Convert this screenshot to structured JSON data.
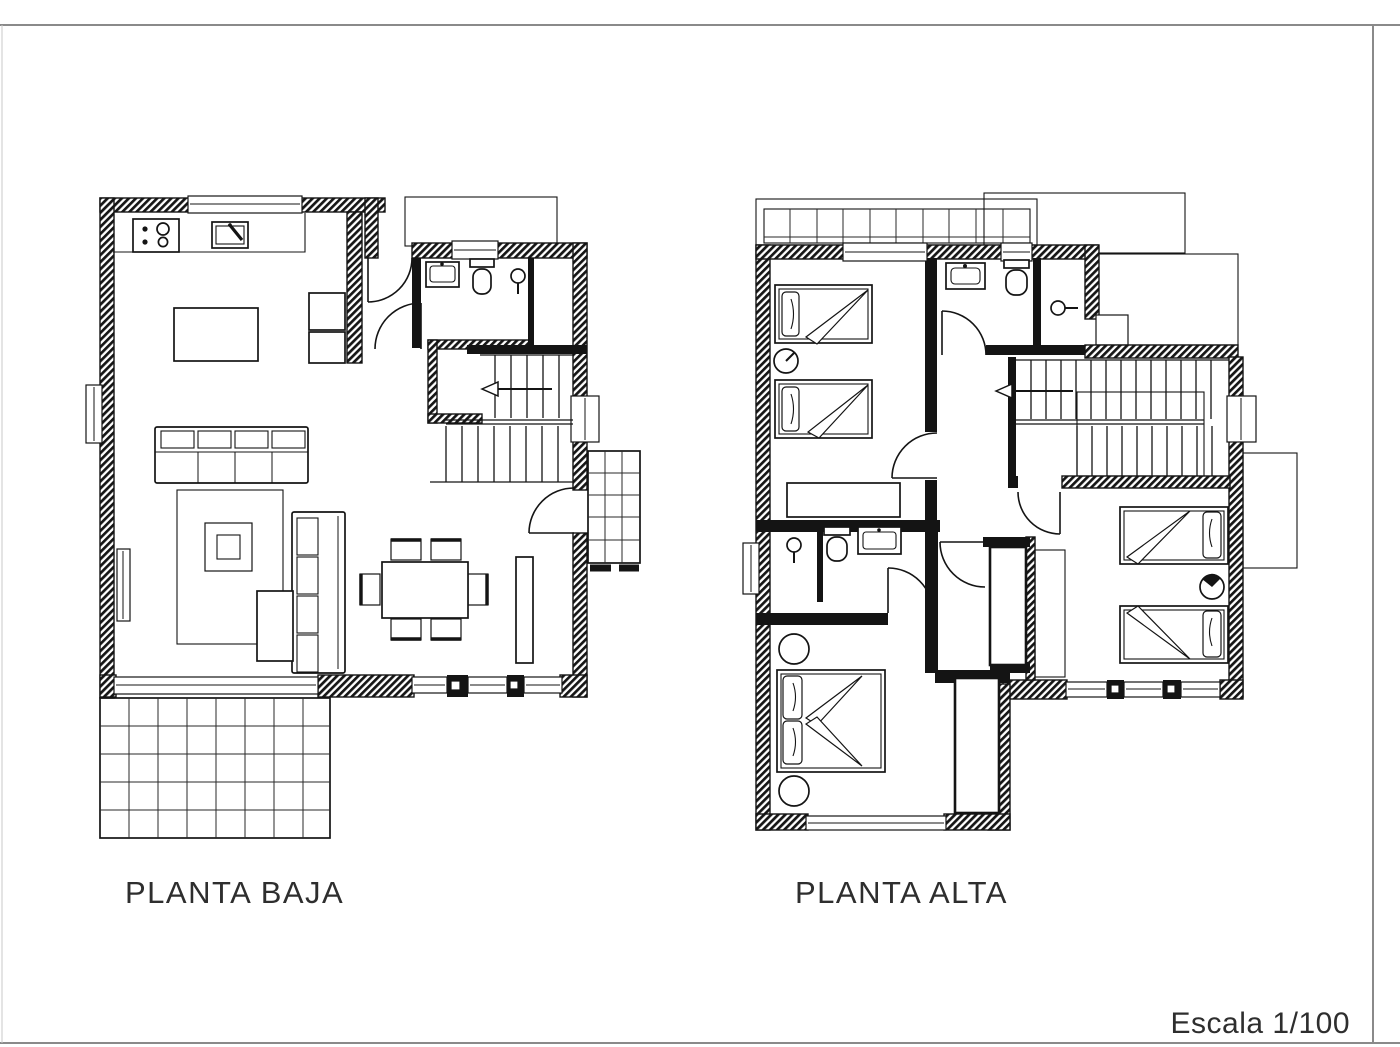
{
  "sheet": {
    "scale_label": "Escala 1/100",
    "paper_color": "#ffffff",
    "line_color": "#141414",
    "frame_color": "#8a8a8a",
    "text_color": "#2e2e2e"
  },
  "plans": [
    {
      "id": "planta-baja",
      "label": "PLANTA BAJA"
    },
    {
      "id": "planta-alta",
      "label": "PLANTA ALTA"
    }
  ],
  "symbols": {
    "stove-icon": "four burner circles on counter rectangle",
    "sink-icon": "rectangle with inner basin and faucet dot",
    "toilet-icon": "cistern bar with rounded bowl",
    "shower-icon": "circle head with arm line",
    "bed-icon": "mattress rectangle with pillow and folded duvet wedge",
    "door-icon": "leaf line with quarter-circle swing arc",
    "stairs-icon": "parallel treads with direction arrow",
    "window-icon": "white break with glass line inside wall",
    "terrace-icon": "square tile grid",
    "wall-hatch-icon": "diagonal insulation hatching"
  }
}
